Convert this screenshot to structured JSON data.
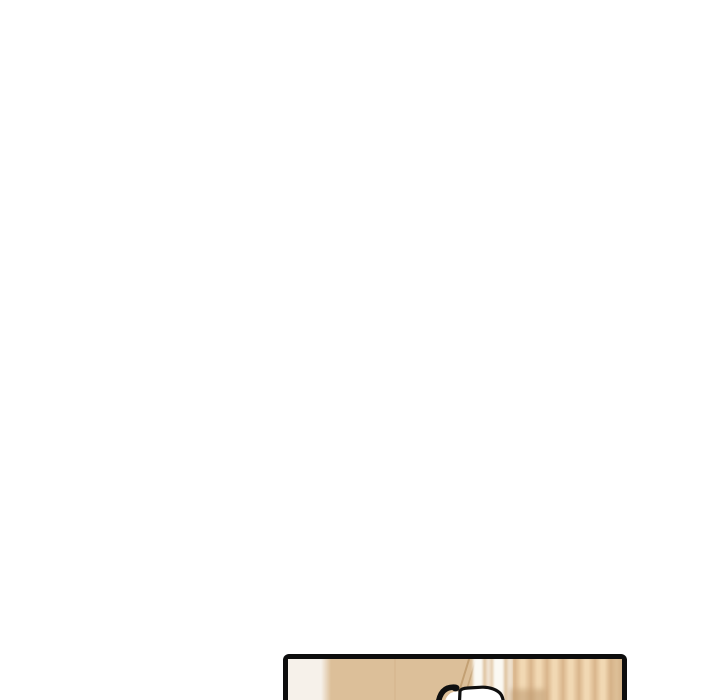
{
  "scene": {
    "kind": "webtoon-page-fragment",
    "gutter_color": "#ffffff",
    "note": "blank vertical-scroll gutter; top edge of a comic panel visible at bottom"
  },
  "panel": {
    "border_color": "#0d0d0d",
    "art_colors": {
      "wall_white": "#f6f1ea",
      "wall_tan": "#dcbf99",
      "wall_seam": "#cdad82",
      "frame_edge": "#bf9b6d",
      "streak_white": "#fdfcf8",
      "plank_dark": "#d9b58c",
      "plank_light": "#f1d8b3",
      "right_shade": "#c9a67b",
      "corner_shadow": "#bd9a6f",
      "sfx_fill": "#ffffff",
      "sfx_outline": "#0f0f0f"
    }
  }
}
